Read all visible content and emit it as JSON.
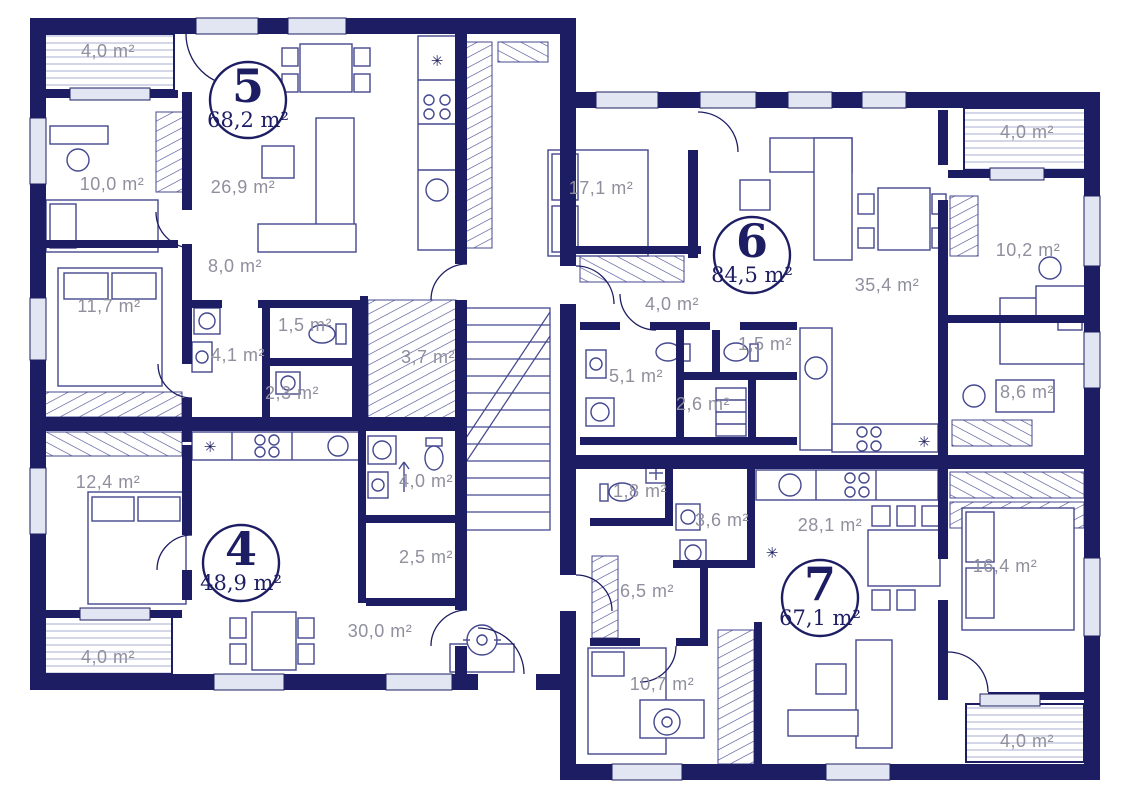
{
  "plan": {
    "type": "apartment-floor-plan",
    "wall_color": "#1d1d63",
    "furniture_line_color": "#44488f",
    "label_color": "#8f8f9e",
    "area_unit": "m²"
  },
  "icons": {
    "fridge": "✳"
  },
  "apartments": [
    {
      "number": "5",
      "area": "68,2 m²",
      "cx": 248,
      "cy": 100,
      "r": 38
    },
    {
      "number": "4",
      "area": "48,9 m²",
      "cx": 241,
      "cy": 563,
      "r": 38
    },
    {
      "number": "6",
      "area": "84,5 m²",
      "cx": 752,
      "cy": 255,
      "r": 38
    },
    {
      "number": "7",
      "area": "67,1 m²",
      "cx": 820,
      "cy": 598,
      "r": 38
    }
  ],
  "rooms": [
    {
      "label": "4,0 m²",
      "x": 108,
      "y": 57,
      "kind": "balcony"
    },
    {
      "label": "10,0 m²",
      "x": 112,
      "y": 190
    },
    {
      "label": "26,9 m²",
      "x": 243,
      "y": 193
    },
    {
      "label": "8,0 m²",
      "x": 235,
      "y": 272
    },
    {
      "label": "11,7 m²",
      "x": 109,
      "y": 312
    },
    {
      "label": "4,1 m²",
      "x": 238,
      "y": 361
    },
    {
      "label": "1,5 m²",
      "x": 305,
      "y": 331
    },
    {
      "label": "2,3 m²",
      "x": 292,
      "y": 399
    },
    {
      "label": "3,7 m²",
      "x": 428,
      "y": 363
    },
    {
      "label": "12,4 m²",
      "x": 108,
      "y": 488
    },
    {
      "label": "4,0 m²",
      "x": 426,
      "y": 487
    },
    {
      "label": "2,5 m²",
      "x": 426,
      "y": 563
    },
    {
      "label": "30,0 m²",
      "x": 380,
      "y": 637
    },
    {
      "label": "4,0 m²",
      "x": 108,
      "y": 663,
      "kind": "balcony"
    },
    {
      "label": "17,1 m²",
      "x": 601,
      "y": 194
    },
    {
      "label": "4,0 m²",
      "x": 672,
      "y": 310
    },
    {
      "label": "5,1 m²",
      "x": 636,
      "y": 382
    },
    {
      "label": "1,5 m²",
      "x": 765,
      "y": 350
    },
    {
      "label": "2,6 m²",
      "x": 703,
      "y": 410
    },
    {
      "label": "35,4 m²",
      "x": 887,
      "y": 291
    },
    {
      "label": "4,0 m²",
      "x": 1027,
      "y": 138,
      "kind": "balcony"
    },
    {
      "label": "10,2 m²",
      "x": 1028,
      "y": 256
    },
    {
      "label": "8,6 m²",
      "x": 1027,
      "y": 398
    },
    {
      "label": "1,8 m²",
      "x": 640,
      "y": 497
    },
    {
      "label": "3,6 m²",
      "x": 722,
      "y": 526
    },
    {
      "label": "28,1 m²",
      "x": 830,
      "y": 531
    },
    {
      "label": "6,5 m²",
      "x": 647,
      "y": 597
    },
    {
      "label": "10,7 m²",
      "x": 662,
      "y": 690
    },
    {
      "label": "16,4 m²",
      "x": 1005,
      "y": 572
    },
    {
      "label": "4,0 m²",
      "x": 1027,
      "y": 747,
      "kind": "balcony"
    }
  ]
}
